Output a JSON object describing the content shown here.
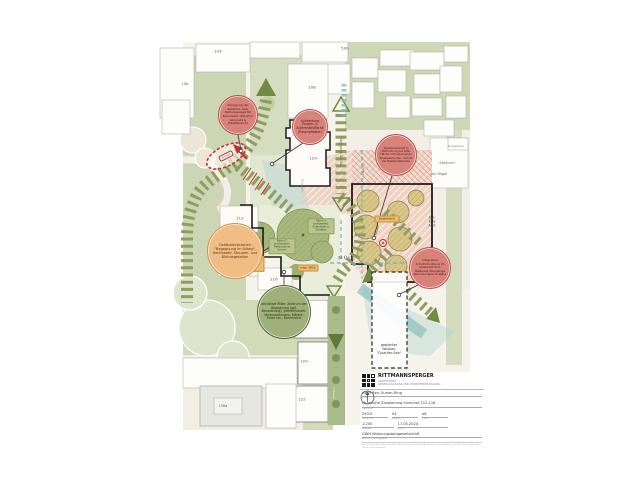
{
  "bubbles": {
    "zufahrt": "Verlegung der Zufahrts- bzw. Rettungswege für Feuerwehr (Struktur kompakt & Platzbereich)",
    "pausenflaeche": "Aufwertung Pausen- & Aufenthaltsfläche (Rasenpflaster)",
    "spiellandschaft": "Spiellandschaft in Verbindung zur KiTa-Fläche mit naturnahen Spielelementen, Schutz der Bestandsbäume",
    "vorzonen": "Gebäudevorzonen \"Begegnung im Alltag\": Hochbeete, Stauden- und Blühvegetation",
    "mitte": "attraktive Mitte: Zentrum der Begegnung (ggf. Neuplanung), gemeinschaftl. Veranstaltungen, Märkte, Feste etc., barrierefrei",
    "schulhof": "Integrative Schulhofnutzung im Spielareal Süd, fließende Übergänge zwischen Spiel & Natur"
  },
  "map_labels": {
    "muell": "MÜLL",
    "uebergang_ost": "Übergang QZ-Ost",
    "unterfuehrung": "Unterführung QZ-Süd",
    "fussweg": "Fußweg",
    "feuerwehr_1": "Feuerwehr",
    "feuerwehr_2": "Feuerwehr",
    "entfaellt": "entfällt",
    "neubau": "geplanter Neubau \"Quartier-See\"",
    "zentrum": "Zentrum",
    "am_buegel": "Am Bügel",
    "buergerhaus": "Bürgerhaus",
    "eg_kita": "EG: KiTa ABG",
    "platz": "Platz im Quartierszentrum: mögl. Ausbau der Hochbeete",
    "muell_opt": "mögl. MÜLL",
    "spielbereich": "Spielbereich",
    "baum1": "Baum 1 (vorhanden): Aufenthalt im Schatten",
    "baum2": "Baum 2 (vorhanden): Treffpunkt im Grünen"
  },
  "buildings": {
    "n104": "104",
    "n50b": "50b",
    "n10b": "10b",
    "n108": "108",
    "n110": "110",
    "n112": "112",
    "n114": "114",
    "n116": "116",
    "n118": "118",
    "n120": "120",
    "n122": "122",
    "n136a": "136a"
  },
  "titleblock": {
    "firm": "RITTMANNSPERGER",
    "firm_sub1": "ARCHITEKTEN",
    "firm_sub2": "GENERALPLANUNG UND PROJEKTENTWICKLUNG",
    "project_value": "GWH Ben-Gurion-Ring",
    "project_label": "Projekt",
    "content_value": "räumliche Zielplanung Innenhof 112-116",
    "content_label": "Planinhalt",
    "num1_value": "29/10",
    "num1_label": "Projekt-Nr.",
    "num2_value": "04",
    "num2_label": "Plan-Nr.",
    "num3_value": "a6",
    "num3_label": "Index",
    "scale_value": "1:200",
    "scale_label": "Maßstab",
    "date_value": "17.05.2024",
    "date_label": "Datum",
    "client_value": "GWH Wohnungsbaugesellschaft",
    "client_label": "Bauherr / Auftraggeber",
    "fineprint": "Alle Maße sind am Bau zu prüfen. Abweichungen sind dem Architekten unverzüglich zu melden. Vervielfältigung nur mit Genehmigung."
  },
  "colors": {
    "path_green": "#8f9e60",
    "arrow_green": "#708b42",
    "bubble_red": "#d9827a",
    "bubble_orange": "#f0bd86",
    "bubble_green": "#9fb07a",
    "teal": "#6fb3b3",
    "salmon": "#eed3c2",
    "alert_red": "#c83030"
  }
}
